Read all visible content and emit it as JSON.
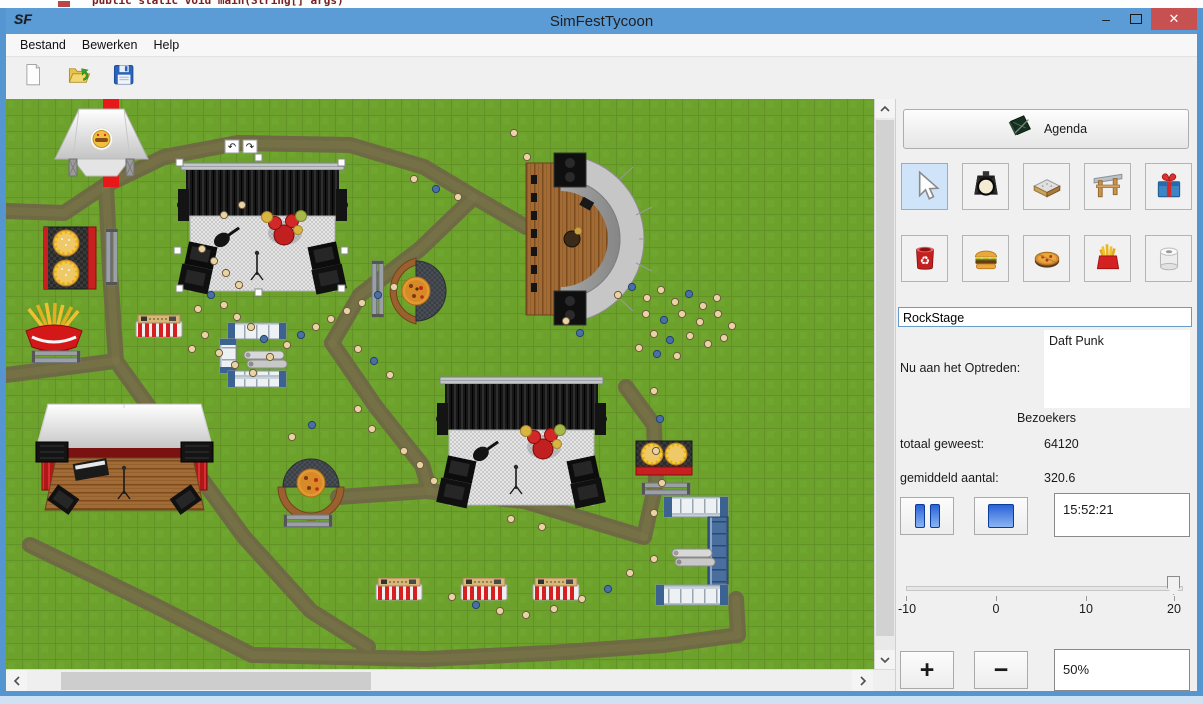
{
  "background": {
    "code_text": "public static void main(String[] args)"
  },
  "window": {
    "title": "SimFestTycoon",
    "icon_text": "SF",
    "controls": {
      "minimize": "–",
      "close": "✕"
    },
    "colors": {
      "titlebar": "#5B9CD6",
      "close": "#C75050",
      "border": "#5596D0"
    }
  },
  "menu": {
    "items": [
      {
        "label": "Bestand"
      },
      {
        "label": "Bewerken"
      },
      {
        "label": "Help"
      }
    ]
  },
  "toolbar": {
    "buttons": [
      {
        "name": "new-file",
        "icon": "new-document-icon"
      },
      {
        "name": "open-file",
        "icon": "open-folder-icon"
      },
      {
        "name": "save-file",
        "icon": "save-icon"
      }
    ]
  },
  "panel": {
    "agenda_label": "Agenda",
    "tool_rows": [
      [
        {
          "name": "select",
          "icon": "cursor-icon",
          "selected": true
        },
        {
          "name": "spotlight",
          "icon": "spotlight-icon"
        },
        {
          "name": "stage",
          "icon": "stage-icon"
        },
        {
          "name": "gate",
          "icon": "gate-icon"
        },
        {
          "name": "gift",
          "icon": "gift-icon"
        }
      ],
      [
        {
          "name": "trash",
          "icon": "trash-icon"
        },
        {
          "name": "burger",
          "icon": "burger-icon"
        },
        {
          "name": "pizza",
          "icon": "pizza-icon"
        },
        {
          "name": "fries",
          "icon": "fries-icon"
        },
        {
          "name": "toilet",
          "icon": "toilet-roll-icon"
        }
      ]
    ],
    "stage_name_value": "RockStage",
    "now_playing_label": "Nu aan het Optreden:",
    "now_playing_value": "Daft Punk",
    "visitors_header": "Bezoekers",
    "total_label": "totaal geweest:",
    "total_value": "64120",
    "average_label": "gemiddeld aantal:",
    "average_value": "320.6",
    "time_value": "15:52:21",
    "slider": {
      "min": -10,
      "max": 20,
      "value": 20,
      "ticks": [
        "-10",
        "0",
        "10",
        "20"
      ]
    },
    "zoom_in_label": "+",
    "zoom_out_label": "−",
    "zoom_value": "50%"
  },
  "map": {
    "grass": {
      "base": "#6CA12C",
      "line": "#5A8424",
      "tile": 16.5
    },
    "path_color": "#6E6A43",
    "path_texture": "#7B7549",
    "red_stripe": {
      "x": 97,
      "y": 0,
      "w": 16,
      "h": 88,
      "color": "#E81818"
    },
    "paths": [
      {
        "points": [
          [
            0,
            112
          ],
          [
            58,
            114
          ],
          [
            100,
            86
          ]
        ]
      },
      {
        "points": [
          [
            100,
            86
          ],
          [
            104,
            172
          ],
          [
            110,
            262
          ]
        ]
      },
      {
        "points": [
          [
            110,
            262
          ],
          [
            0,
            276
          ]
        ]
      },
      {
        "points": [
          [
            110,
            262
          ],
          [
            172,
            348
          ],
          [
            238,
            438
          ],
          [
            305,
            512
          ],
          [
            362,
            548
          ]
        ]
      },
      {
        "points": [
          [
            100,
            86
          ],
          [
            158,
            58
          ],
          [
            232,
            44
          ],
          [
            344,
            46
          ],
          [
            418,
            68
          ],
          [
            468,
            98
          ],
          [
            520,
            128
          ]
        ]
      },
      {
        "points": [
          [
            468,
            98
          ],
          [
            414,
            150
          ],
          [
            354,
            196
          ],
          [
            326,
            244
          ]
        ]
      },
      {
        "points": [
          [
            326,
            244
          ],
          [
            370,
            308
          ],
          [
            416,
            366
          ],
          [
            424,
            392
          ]
        ]
      },
      {
        "points": [
          [
            332,
            398
          ],
          [
            420,
            392
          ],
          [
            518,
            402
          ],
          [
            638,
            438
          ]
        ]
      },
      {
        "points": [
          [
            638,
            438
          ],
          [
            650,
            384
          ],
          [
            648,
            326
          ],
          [
            620,
            288
          ]
        ]
      },
      {
        "points": [
          [
            24,
            446
          ],
          [
            148,
            506
          ],
          [
            246,
            556
          ],
          [
            420,
            560
          ],
          [
            544,
            554
          ],
          [
            658,
            546
          ],
          [
            732,
            536
          ],
          [
            730,
            500
          ]
        ]
      }
    ],
    "objects": [
      {
        "type": "tent",
        "x": 49,
        "y": 10
      },
      {
        "type": "burger-stand-v",
        "x": 38,
        "y": 128
      },
      {
        "type": "bench-v",
        "x": 100,
        "y": 130
      },
      {
        "type": "fries-stand",
        "x": 18,
        "y": 198
      },
      {
        "type": "bench-h",
        "x": 26,
        "y": 252
      },
      {
        "type": "stall",
        "x": 130,
        "y": 216
      },
      {
        "type": "barrier-c",
        "x": 214,
        "y": 224
      },
      {
        "type": "tubes",
        "x": 238,
        "y": 252
      },
      {
        "type": "big-stage",
        "x": 175,
        "y": 48,
        "selected": true
      },
      {
        "type": "pizza-stand-right",
        "x": 380,
        "y": 160
      },
      {
        "type": "bench-v",
        "x": 366,
        "y": 162
      },
      {
        "type": "amphitheater",
        "x": 520,
        "y": 56
      },
      {
        "type": "barn-stage",
        "x": 30,
        "y": 305
      },
      {
        "type": "pizza-stand-bottom",
        "x": 275,
        "y": 362
      },
      {
        "type": "bench-h",
        "x": 278,
        "y": 416
      },
      {
        "type": "big-stage",
        "x": 434,
        "y": 262,
        "selected": false
      },
      {
        "type": "burger-stand-h",
        "x": 630,
        "y": 342
      },
      {
        "type": "bench-h",
        "x": 636,
        "y": 384
      },
      {
        "type": "barrier-u",
        "x": 650,
        "y": 398
      },
      {
        "type": "tubes",
        "x": 666,
        "y": 450
      },
      {
        "type": "stall",
        "x": 370,
        "y": 479
      },
      {
        "type": "stall",
        "x": 455,
        "y": 479
      },
      {
        "type": "stall",
        "x": 527,
        "y": 479
      }
    ],
    "visitors": {
      "tan": "#E9D3A5",
      "blue": "#4A6FA5",
      "positions": [
        [
          196,
          150,
          0
        ],
        [
          208,
          162,
          0
        ],
        [
          220,
          174,
          0
        ],
        [
          233,
          186,
          0
        ],
        [
          205,
          196,
          1
        ],
        [
          192,
          210,
          0
        ],
        [
          218,
          206,
          0
        ],
        [
          231,
          218,
          0
        ],
        [
          245,
          228,
          0
        ],
        [
          258,
          240,
          1
        ],
        [
          199,
          236,
          0
        ],
        [
          186,
          250,
          0
        ],
        [
          213,
          254,
          0
        ],
        [
          229,
          266,
          0
        ],
        [
          247,
          274,
          0
        ],
        [
          264,
          258,
          0
        ],
        [
          281,
          246,
          0
        ],
        [
          295,
          236,
          1
        ],
        [
          310,
          228,
          0
        ],
        [
          325,
          220,
          0
        ],
        [
          341,
          212,
          0
        ],
        [
          356,
          204,
          0
        ],
        [
          372,
          196,
          1
        ],
        [
          388,
          188,
          0
        ],
        [
          218,
          116,
          0
        ],
        [
          236,
          106,
          0
        ],
        [
          408,
          80,
          0
        ],
        [
          430,
          90,
          1
        ],
        [
          452,
          98,
          0
        ],
        [
          508,
          34,
          0
        ],
        [
          521,
          58,
          0
        ],
        [
          352,
          250,
          0
        ],
        [
          368,
          262,
          1
        ],
        [
          384,
          276,
          0
        ],
        [
          352,
          310,
          0
        ],
        [
          366,
          330,
          0
        ],
        [
          306,
          326,
          1
        ],
        [
          286,
          338,
          0
        ],
        [
          398,
          352,
          0
        ],
        [
          414,
          366,
          0
        ],
        [
          428,
          382,
          0
        ],
        [
          446,
          498,
          0
        ],
        [
          470,
          506,
          1
        ],
        [
          494,
          512,
          0
        ],
        [
          520,
          516,
          0
        ],
        [
          548,
          510,
          0
        ],
        [
          576,
          500,
          0
        ],
        [
          602,
          490,
          1
        ],
        [
          624,
          474,
          0
        ],
        [
          648,
          460,
          0
        ],
        [
          612,
          196,
          0
        ],
        [
          626,
          188,
          1
        ],
        [
          641,
          199,
          0
        ],
        [
          655,
          191,
          0
        ],
        [
          669,
          203,
          0
        ],
        [
          683,
          195,
          1
        ],
        [
          697,
          207,
          0
        ],
        [
          711,
          199,
          0
        ],
        [
          640,
          215,
          0
        ],
        [
          658,
          221,
          1
        ],
        [
          676,
          215,
          0
        ],
        [
          694,
          223,
          0
        ],
        [
          712,
          215,
          0
        ],
        [
          726,
          227,
          0
        ],
        [
          648,
          235,
          0
        ],
        [
          664,
          241,
          1
        ],
        [
          684,
          237,
          0
        ],
        [
          702,
          245,
          0
        ],
        [
          718,
          239,
          0
        ],
        [
          633,
          249,
          0
        ],
        [
          651,
          255,
          1
        ],
        [
          671,
          257,
          0
        ],
        [
          648,
          292,
          0
        ],
        [
          654,
          320,
          1
        ],
        [
          650,
          352,
          0
        ],
        [
          656,
          384,
          0
        ],
        [
          648,
          414,
          0
        ],
        [
          560,
          222,
          0
        ],
        [
          574,
          234,
          1
        ],
        [
          505,
          420,
          0
        ],
        [
          536,
          428,
          0
        ]
      ]
    }
  }
}
